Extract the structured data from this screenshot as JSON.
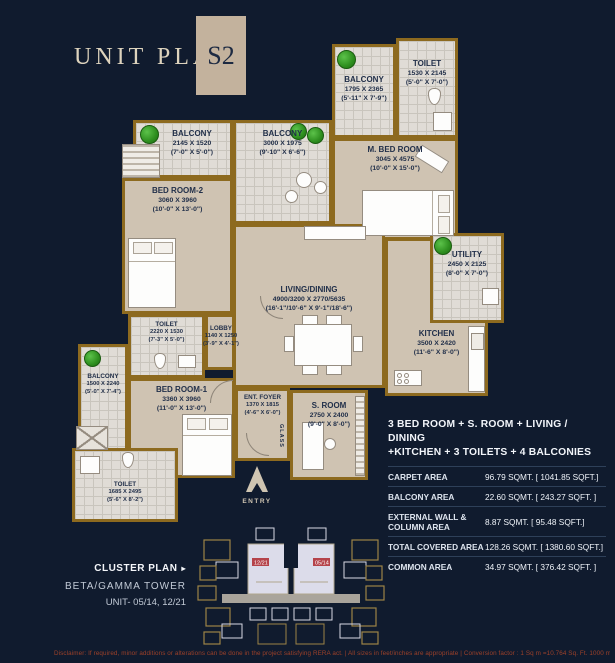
{
  "header": {
    "title": "UNIT PLAN",
    "plan_code": "S2"
  },
  "plan": {
    "rooms": {
      "balcony_top": {
        "name": "BALCONY",
        "mm": "1795 X 2365",
        "ft": "(5'-11\" X 7'-9\")"
      },
      "toilet_top": {
        "name": "TOILET",
        "mm": "1530 X 2145",
        "ft": "(5'-0\" X 7'-0\")"
      },
      "m_bedroom": {
        "name": "M. BED ROOM",
        "mm": "3045 X 4575",
        "ft": "(10'-0\" X 15'-0\")"
      },
      "balcony_left_top": {
        "name": "BALCONY",
        "mm": "2145 X 1520",
        "ft": "(7'-0\" X 5'-0\")"
      },
      "balcony_mid_top": {
        "name": "BALCONY",
        "mm": "3000 X 1975",
        "ft": "(9'-10\" X 6'-6\")"
      },
      "bedroom2": {
        "name": "BED ROOM-2",
        "mm": "3060 X 3960",
        "ft": "(10'-0\" X 13'-0\")"
      },
      "living": {
        "name": "LIVING/DINING",
        "mm": "4900/3200 X 2770/5635",
        "ft": "(16'-1\"/10'-6\" X 9'-1\"/18'-6\")"
      },
      "utility": {
        "name": "UTILITY",
        "mm": "2450 X 2125",
        "ft": "(8'-0\" X 7'-0\")"
      },
      "kitchen": {
        "name": "KITCHEN",
        "mm": "3500 X 2420",
        "ft": "(11'-6\" X 8'-0\")"
      },
      "toilet_mid": {
        "name": "TOILET",
        "mm": "2220 X 1530",
        "ft": "(7'-3\" X 5'-0\")"
      },
      "lobby": {
        "name": "LOBBY",
        "mm": "1140 X 1250",
        "ft": "(3'-9\" X 4'-1\")"
      },
      "balcony_left_bot": {
        "name": "BALCONY",
        "mm": "1500 X 2240",
        "ft": "(5'-0\" X 7'-4\")"
      },
      "bedroom1": {
        "name": "BED ROOM-1",
        "mm": "3360 X 3960",
        "ft": "(11'-0\" X 13'-0\")"
      },
      "toilet_bottom": {
        "name": "TOILET",
        "mm": "1685 X 2495",
        "ft": "(5'-6\" X 8'-2\")"
      },
      "ent_foyer": {
        "name": "ENT. FOYER",
        "mm": "1370 X 1815",
        "ft": "(4'-6\" X 6'-0\")"
      },
      "s_room": {
        "name": "S. ROOM",
        "mm": "2750 X 2400",
        "ft": "(9'-0\" X 8'-0\")"
      }
    },
    "labels": {
      "glass": "GLASS",
      "entry": "ENTRY"
    }
  },
  "summary": {
    "line1": "3 BED ROOM + S. ROOM + LIVING / DINING",
    "line2": "+KITCHEN + 3 TOILETS + 4 BALCONIES",
    "rows": [
      {
        "label": "CARPET AREA",
        "value": "96.79 SQMT. [ 1041.85 SQFT.]"
      },
      {
        "label": "BALCONY AREA",
        "value": "22.60 SQMT. [ 243.27 SQFT. ]"
      },
      {
        "label": "EXTERNAL WALL & COLUMN AREA",
        "value": "8.87 SQMT. [ 95.48 SQFT.]"
      },
      {
        "label": "TOTAL COVERED AREA",
        "value": "128.26 SQMT. [ 1380.60 SQFT.]"
      },
      {
        "label": "COMMON AREA",
        "value": "34.97 SQMT. [ 376.42 SQFT. ]"
      }
    ]
  },
  "cluster": {
    "label": "CLUSTER PLAN",
    "arrow_icon": "▸",
    "tower": "BETA/GAMMA TOWER",
    "unit": "UNIT- 05/14, 12/21",
    "unit_tags": [
      "12/21",
      "05/14"
    ]
  },
  "disclaimer": "Disclaimer:  If required, minor additions or alterations can be done in the project satisfying RERA act.  |  All sizes in feet/inches are appropriate  |  Conversion factor : 1 Sq m =10.764 Sq. Ft. 1000 mm=3.28 Ft",
  "colors": {
    "background": "#101b2e",
    "wall": "#8d6a1f",
    "floor": "#cfc3b2",
    "tile": "#e0dcd6",
    "badge": "#c3b29d",
    "tag_red": "#b5434a",
    "disclaimer": "#9d4129"
  }
}
